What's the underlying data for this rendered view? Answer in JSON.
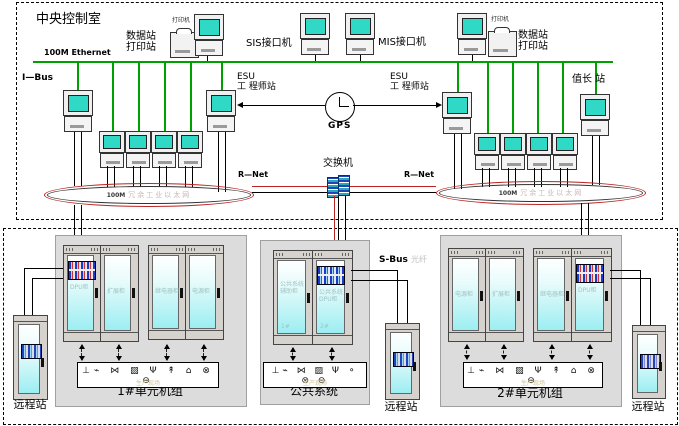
{
  "control_room": {
    "title": "中央控制室",
    "ethernet_label": "100M Ethernet",
    "ibus_label": "I—Bus",
    "data_print_station_left": "数据站\n打印站",
    "printer_label_left": "打印机",
    "sis_label": "SIS接口机",
    "mis_label": "MIS接口机",
    "data_print_station_right": "数据站\n打印站",
    "printer_label_right": "打印机",
    "esu_left_label": "ESU\n工 程师站",
    "esu_right_label": "ESU\n工 程师站",
    "shift_leader_label": "值长 站",
    "gps_label": "GPS",
    "switch_label": "交换机",
    "rnet_left_label": "R—Net",
    "rnet_right_label": "R—Net",
    "ring_left": {
      "prefix": "100M",
      "name": "冗余工业以太网"
    },
    "ring_right": {
      "prefix": "100M",
      "name": "冗余工业以太网"
    }
  },
  "plant": {
    "sbus_label": "S-Bus",
    "sbus_fiber_label": "光纤",
    "unit1": {
      "title": "1#单元机组",
      "cabinets": [
        "DPU柜",
        "扩展柜",
        "继电器柜",
        "电源柜"
      ],
      "field_label": "生产现场",
      "field_icons": "⊥⌁ ⋈ ▨ Ψ ↟ ⌂ ⊗ ⊖"
    },
    "common": {
      "title": "公共系统",
      "cabinets": [
        "公共系统\n辅助柜",
        "公共系统\nDPU柜"
      ],
      "cabinet_nums": [
        "1#",
        "2#"
      ],
      "field_label": "生产现场",
      "field_icons": "⊥⌁ ⋈ ▨ Ψ ⚬ ⊗ ⊖"
    },
    "unit2": {
      "title": "2#单元机组",
      "cabinets": [
        "电源柜",
        "扩展柜",
        "继电器柜",
        "DPU柜"
      ],
      "field_label": "生产现场",
      "field_icons": "⊥⌁ ⋈ ▨ Ψ ↟ ⌂ ⊗ ⊖"
    },
    "remote_left_label": "远程站",
    "remote_mid_label": "远程站",
    "remote_right_label": "远程站"
  },
  "colors": {
    "ethernet_green": "#00a000",
    "ring_red": "#bb2222",
    "screen_teal": "#2fd9c6"
  }
}
